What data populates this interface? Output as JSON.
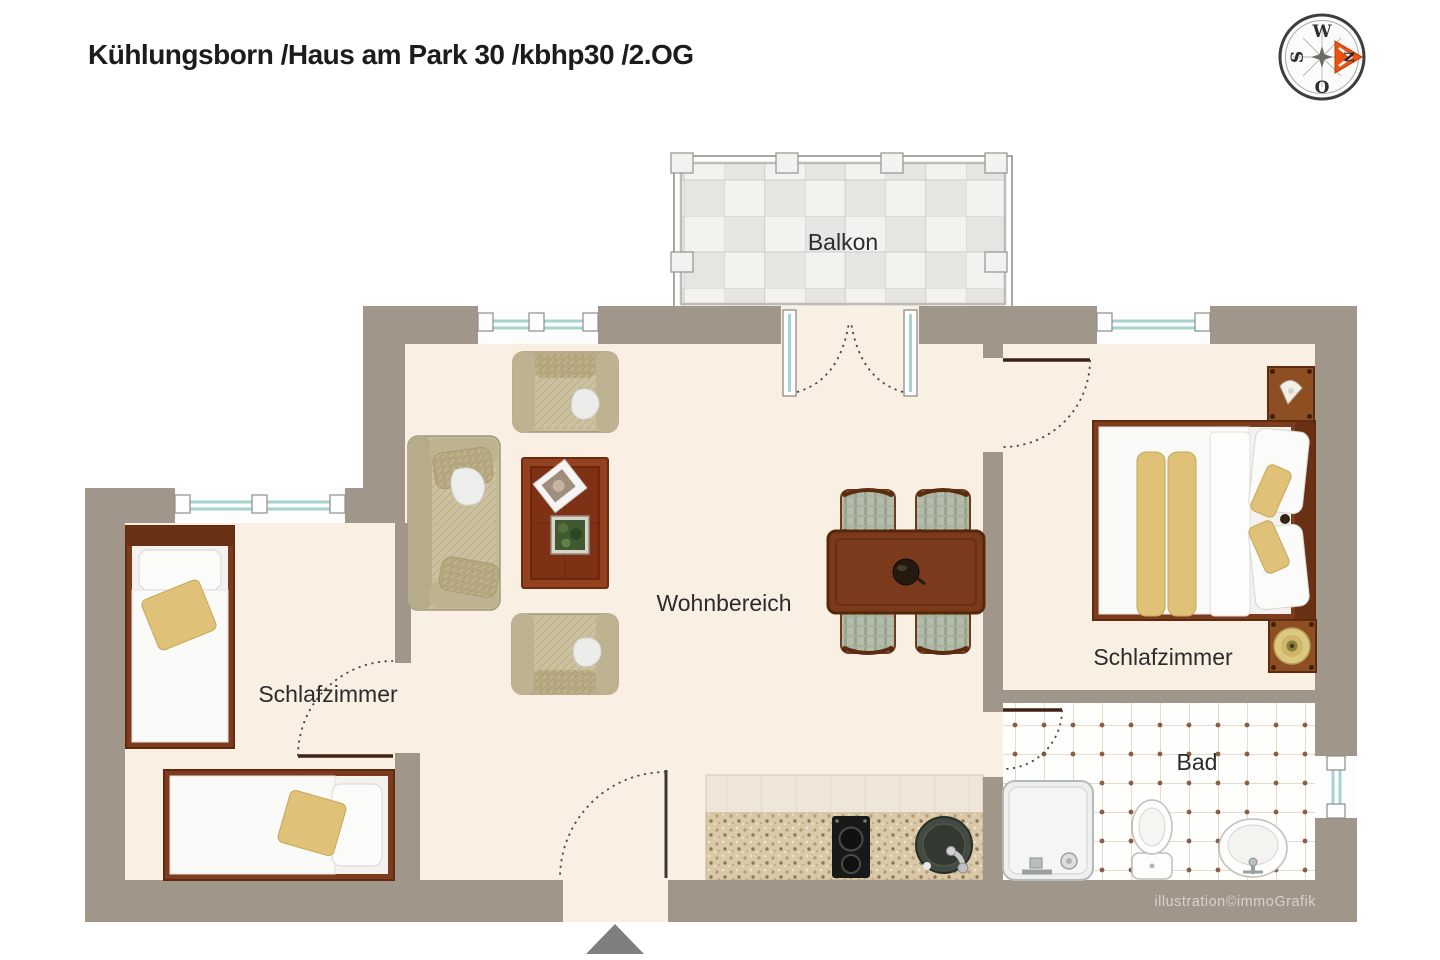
{
  "header": {
    "title": "Kühlungsborn /Haus am Park 30 /kbhp30 /2.OG"
  },
  "compass": {
    "north": "N",
    "east": "O",
    "south": "S",
    "west": "W"
  },
  "rooms": {
    "balcony": {
      "label": "Balkon"
    },
    "living": {
      "label": "Wohnbereich"
    },
    "bedroom_left": {
      "label": "Schlafzimmer"
    },
    "bedroom_right": {
      "label": "Schlafzimmer"
    },
    "bathroom": {
      "label": "Bad"
    }
  },
  "footer": {
    "credit": "illustration©immoGrafik"
  },
  "colors": {
    "wall": "#a1968a",
    "floor": "#f9efe3",
    "wood_frame": "#7e3c1e",
    "table_wood": "#7b3a1c",
    "upholstery_tan": "#c6bc9a",
    "accent_yellow": "#dfc177",
    "window_glass": "#a7d2d2",
    "compass_arrow": "#e85312",
    "bath_tile_dot": "#8a5e46",
    "entrance_arrow": "#7f7f7f"
  }
}
